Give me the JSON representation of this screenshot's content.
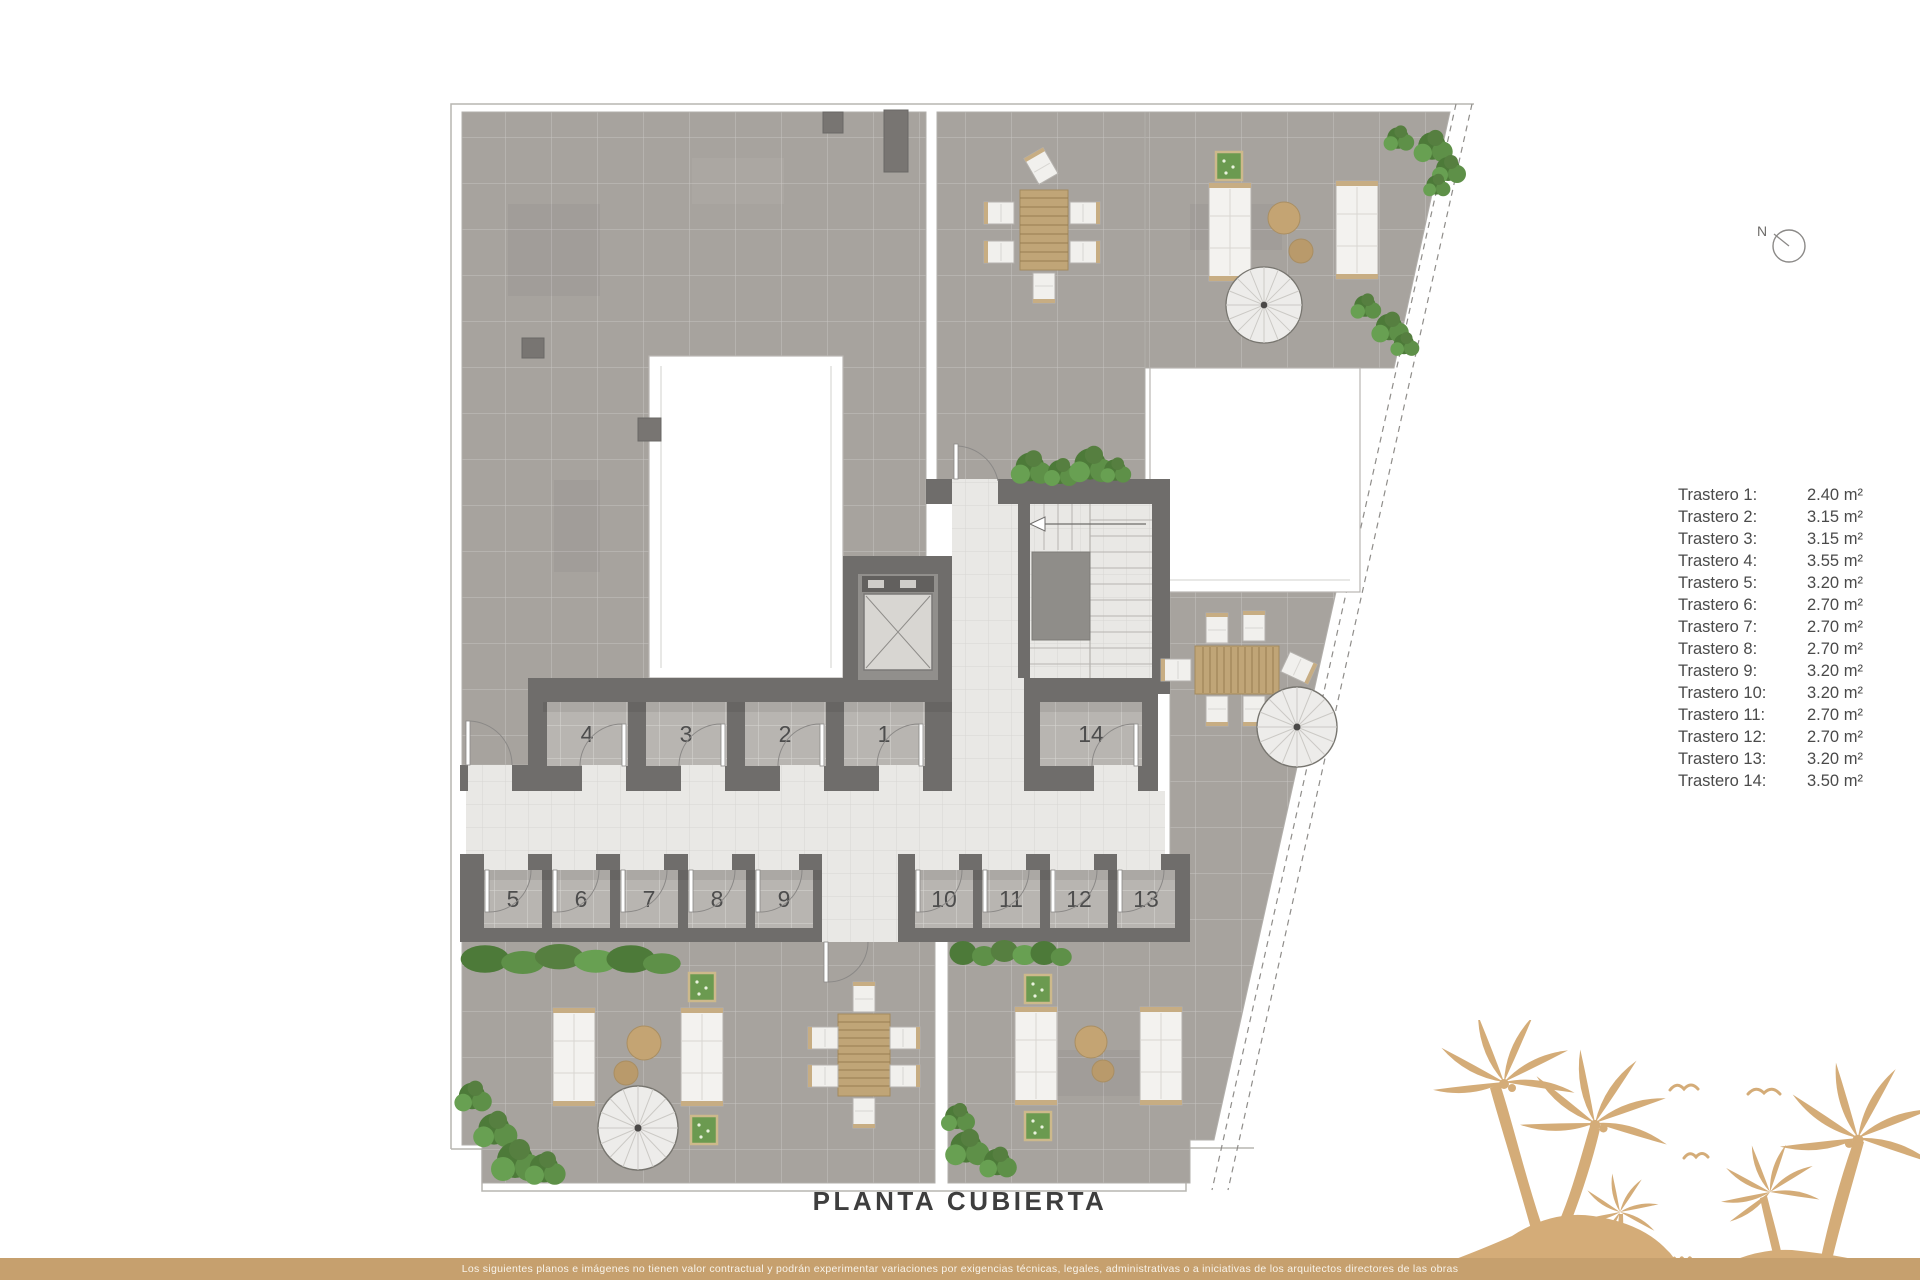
{
  "title": "PLANTA CUBIERTA",
  "compass": {
    "label": "N"
  },
  "legend": {
    "rows": [
      {
        "label": "Trastero 1:",
        "value": "2.40 m²"
      },
      {
        "label": "Trastero 2:",
        "value": "3.15 m²"
      },
      {
        "label": "Trastero 3:",
        "value": "3.15 m²"
      },
      {
        "label": "Trastero 4:",
        "value": "3.55 m²"
      },
      {
        "label": "Trastero 5:",
        "value": "3.20 m²"
      },
      {
        "label": "Trastero 6:",
        "value": "2.70 m²"
      },
      {
        "label": "Trastero 7:",
        "value": "2.70 m²"
      },
      {
        "label": "Trastero 8:",
        "value": "2.70 m²"
      },
      {
        "label": "Trastero 9:",
        "value": "3.20 m²"
      },
      {
        "label": "Trastero 10:",
        "value": "3.20 m²"
      },
      {
        "label": "Trastero 11:",
        "value": "2.70 m²"
      },
      {
        "label": "Trastero 12:",
        "value": "2.70 m²"
      },
      {
        "label": "Trastero 13:",
        "value": "3.20 m²"
      },
      {
        "label": "Trastero 14:",
        "value": "3.50 m²"
      }
    ]
  },
  "plan": {
    "rooms": [
      {
        "number": "1"
      },
      {
        "number": "2"
      },
      {
        "number": "3"
      },
      {
        "number": "4"
      },
      {
        "number": "5"
      },
      {
        "number": "6"
      },
      {
        "number": "7"
      },
      {
        "number": "8"
      },
      {
        "number": "9"
      },
      {
        "number": "10"
      },
      {
        "number": "11"
      },
      {
        "number": "12"
      },
      {
        "number": "13"
      },
      {
        "number": "14"
      }
    ]
  },
  "footer": {
    "disclaimer": "Los siguientes planos e imágenes no tienen valor contractual y podrán experimentar variaciones por exigencias técnicas, legales, administrativas o a iniciativas de los arquitectos directores de las obras"
  },
  "colors": {
    "accent_tan": "#c6a06e",
    "palm_tan": "#d4ac78",
    "terrace_gray": "#a7a39e",
    "wall_gray": "#6f6d6b",
    "corridor_light": "#e9e8e5",
    "room_floor": "#b8b5b1",
    "plant_green": "#4d7a39",
    "text_dark": "#4a4a4a"
  }
}
